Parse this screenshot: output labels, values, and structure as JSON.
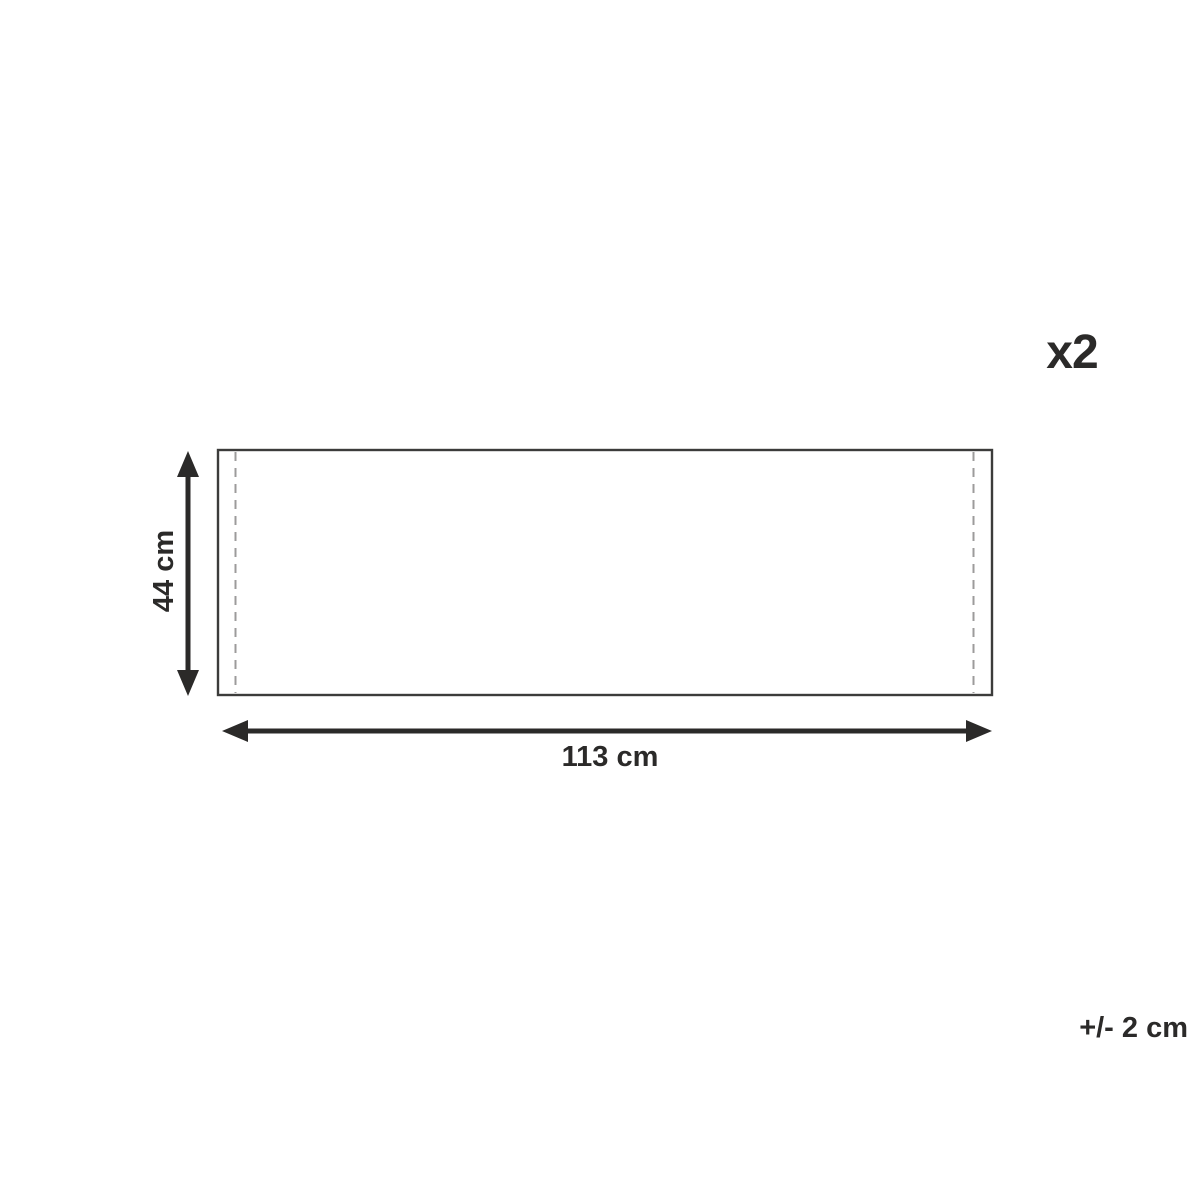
{
  "diagram": {
    "quantity_label": "x2",
    "height_dimension": "44 cm",
    "width_dimension": "113 cm",
    "tolerance": "+/- 2 cm",
    "colors": {
      "background": "#ffffff",
      "arrow_and_text": "#2b2a29",
      "outline": "#3c3c3b",
      "dashed_seam": "#9c9b9b"
    }
  }
}
